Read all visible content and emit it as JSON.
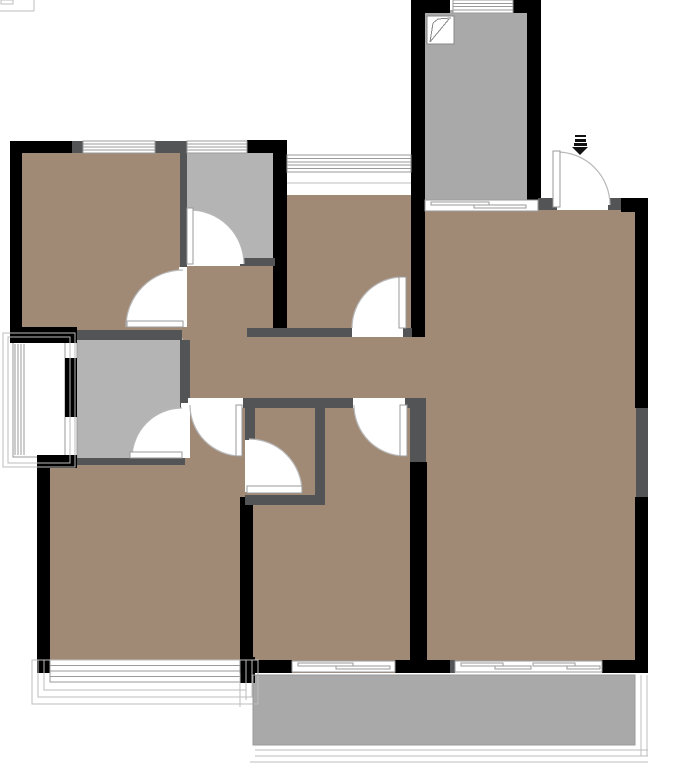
{
  "meta": {
    "width": 680,
    "height": 763,
    "kind": "apartment-floor-plan"
  },
  "plan": {
    "colors": {
      "floor": "#a08a76",
      "gray": "#b4b4b4",
      "balcony": "#a9a9a9",
      "wall_black": "#000000",
      "wall_dark": "#535456",
      "line": "#9a9a9a",
      "line_light": "#bdbdbd",
      "arc": "#b8b8b8",
      "icon": "#111111",
      "white": "#ffffff"
    },
    "fills": [
      {
        "name": "room-master-bedroom",
        "x": 22,
        "y": 152,
        "w": 165,
        "h": 185,
        "c": "floor"
      },
      {
        "name": "room-kitchen",
        "x": 285,
        "y": 172,
        "w": 128,
        "h": 165,
        "c": "floor"
      },
      {
        "name": "room-hallway",
        "x": 180,
        "y": 258,
        "w": 107,
        "h": 150,
        "c": "floor"
      },
      {
        "name": "room-corridor",
        "x": 287,
        "y": 328,
        "w": 140,
        "h": 70,
        "c": "floor"
      },
      {
        "name": "room-bedroom-left-nook",
        "x": 182,
        "y": 398,
        "w": 65,
        "h": 72,
        "c": "floor"
      },
      {
        "name": "room-bedroom-left",
        "x": 37,
        "y": 455,
        "w": 216,
        "h": 218,
        "c": "floor"
      },
      {
        "name": "room-bedroom-center",
        "x": 240,
        "y": 398,
        "w": 187,
        "h": 275,
        "c": "floor"
      },
      {
        "name": "room-living-dining",
        "x": 413,
        "y": 208,
        "w": 235,
        "h": 460,
        "c": "floor"
      },
      {
        "name": "room-walkin-gray",
        "x": 186,
        "y": 152,
        "w": 89,
        "h": 110,
        "c": "gray"
      },
      {
        "name": "room-bathroom",
        "x": 77,
        "y": 338,
        "w": 106,
        "h": 124,
        "c": "gray"
      },
      {
        "name": "room-balcony-top",
        "x": 425,
        "y": 10,
        "w": 102,
        "h": 192,
        "c": "balcony"
      },
      {
        "name": "room-balcony-bottom",
        "x": 253,
        "y": 675,
        "w": 382,
        "h": 70,
        "c": "balcony"
      }
    ],
    "walls_black": [
      [
        10,
        141,
        12,
        202
      ],
      [
        10,
        141,
        62,
        12
      ],
      [
        247,
        140,
        40,
        13
      ],
      [
        273,
        140,
        14,
        197
      ],
      [
        10,
        327,
        67,
        16
      ],
      [
        65,
        358,
        12,
        59
      ],
      [
        37,
        455,
        13,
        218
      ],
      [
        37,
        455,
        40,
        13
      ],
      [
        240,
        497,
        13,
        166
      ],
      [
        240,
        657,
        15,
        26
      ],
      [
        253,
        660,
        39,
        13
      ],
      [
        395,
        660,
        55,
        13
      ],
      [
        602,
        660,
        46,
        13
      ],
      [
        635,
        200,
        13,
        208
      ],
      [
        635,
        497,
        13,
        165
      ],
      [
        621,
        198,
        27,
        14
      ],
      [
        411,
        0,
        14,
        337
      ],
      [
        527,
        0,
        14,
        200
      ],
      [
        411,
        0,
        39,
        13
      ],
      [
        512,
        0,
        26,
        13
      ],
      [
        410,
        462,
        17,
        198
      ]
    ],
    "walls_dark": [
      [
        72,
        141,
        11,
        12
      ],
      [
        155,
        141,
        32,
        12
      ],
      [
        180,
        152,
        7,
        115
      ],
      [
        240,
        258,
        35,
        8
      ],
      [
        77,
        330,
        105,
        10
      ],
      [
        180,
        340,
        10,
        63
      ],
      [
        77,
        458,
        108,
        7
      ],
      [
        247,
        328,
        106,
        9
      ],
      [
        402,
        328,
        10,
        9
      ],
      [
        180,
        398,
        8,
        10
      ],
      [
        243,
        398,
        110,
        10
      ],
      [
        403,
        398,
        12,
        10
      ],
      [
        245,
        408,
        10,
        34
      ],
      [
        315,
        408,
        10,
        87
      ],
      [
        245,
        495,
        80,
        10
      ],
      [
        410,
        398,
        16,
        64
      ],
      [
        538,
        198,
        19,
        12
      ],
      [
        608,
        198,
        13,
        12
      ],
      [
        636,
        408,
        12,
        89
      ],
      [
        450,
        660,
        5,
        13
      ]
    ],
    "thresholds": [
      [
        179,
        267,
        8,
        60
      ],
      [
        187,
        258,
        53,
        8
      ],
      [
        181,
        403,
        9,
        55
      ],
      [
        352,
        328,
        51,
        9
      ],
      [
        188,
        398,
        55,
        10
      ],
      [
        353,
        398,
        52,
        10
      ],
      [
        245,
        440,
        10,
        52
      ],
      [
        557,
        198,
        51,
        12
      ],
      [
        287,
        172,
        124,
        23
      ]
    ],
    "windows": [
      {
        "x": 83,
        "y": 141,
        "w": 72,
        "h": 12,
        "n": 3
      },
      {
        "x": 187,
        "y": 141,
        "w": 60,
        "h": 12,
        "n": 3
      },
      {
        "x": 453,
        "y": 0,
        "w": 60,
        "h": 13,
        "n": 3
      },
      {
        "x": 287,
        "y": 155,
        "w": 124,
        "h": 17,
        "n": 4
      },
      {
        "x": 50,
        "y": 660,
        "w": 190,
        "h": 22,
        "n": 3
      }
    ],
    "sliding": [
      {
        "x": 425,
        "y": 200,
        "w": 113,
        "h": 11,
        "segs": [
          [
            431,
            202,
            58,
            3
          ],
          [
            474,
            205,
            52,
            3
          ]
        ]
      },
      {
        "x": 292,
        "y": 661,
        "w": 103,
        "h": 11,
        "segs": [
          [
            298,
            663,
            55,
            3
          ],
          [
            336,
            666,
            54,
            3
          ]
        ]
      },
      {
        "x": 455,
        "y": 661,
        "w": 147,
        "h": 11,
        "segs": [
          [
            461,
            663,
            42,
            3
          ],
          [
            495,
            666,
            36,
            3
          ],
          [
            533,
            663,
            42,
            3
          ],
          [
            567,
            666,
            33,
            3
          ]
        ]
      }
    ],
    "white_rects": [
      [
        13,
        342,
        52,
        115
      ],
      [
        65,
        342,
        12,
        17
      ],
      [
        65,
        416,
        12,
        42
      ]
    ],
    "stroke_rects": [
      {
        "r": [
          8,
          337,
          62,
          126
        ],
        "c": "line_light"
      },
      {
        "r": [
          3,
          333,
          72,
          134
        ],
        "c": "line_light"
      },
      {
        "r": [
          44,
          660,
          202,
          30
        ],
        "c": "line_light"
      },
      {
        "r": [
          38,
          660,
          214,
          37
        ],
        "c": "line_light"
      },
      {
        "r": [
          32,
          660,
          226,
          44
        ],
        "c": "line_light"
      },
      {
        "r": [
          253,
          675,
          382,
          70
        ],
        "c": "line"
      },
      {
        "r": [
          1,
          0,
          12,
          4
        ],
        "c": "line_light"
      }
    ],
    "lines": [
      {
        "p": [
          287,
          183,
          411,
          183
        ],
        "c": "line_light"
      },
      {
        "p": [
          15,
          344,
          15,
          455
        ],
        "c": "line"
      },
      {
        "p": [
          18,
          344,
          18,
          455
        ],
        "c": "line"
      },
      {
        "p": [
          21,
          344,
          21,
          455
        ],
        "c": "line"
      },
      {
        "p": [
          24,
          344,
          24,
          455
        ],
        "c": "line"
      },
      {
        "p": [
          255,
          750,
          648,
          750
        ],
        "c": "line_light"
      },
      {
        "p": [
          255,
          756,
          648,
          756
        ],
        "c": "line_light"
      },
      {
        "p": [
          250,
          762,
          648,
          762
        ],
        "c": "line_light"
      },
      {
        "p": [
          641,
          675,
          641,
          756
        ],
        "c": "line_light"
      },
      {
        "p": [
          647,
          675,
          647,
          756
        ],
        "c": "line_light"
      },
      {
        "p": [
          240,
          673,
          240,
          707
        ],
        "c": "line_light"
      },
      {
        "p": [
          246,
          673,
          246,
          700
        ],
        "c": "line_light"
      },
      {
        "p": [
          0,
          11,
          34,
          11
        ],
        "c": "line_light"
      },
      {
        "p": [
          34,
          0,
          34,
          11
        ],
        "c": "line_light"
      }
    ],
    "doors": [
      {
        "name": "door-master-bedroom",
        "cx": 183,
        "cy": 327,
        "r": 57,
        "x1": 183,
        "y1": 270,
        "x2": 126,
        "y2": 327,
        "sweep": 0,
        "leaf": [
          127,
          321,
          56,
          6
        ]
      },
      {
        "name": "door-walkin-gray",
        "cx": 190,
        "cy": 264,
        "r": 54,
        "x1": 190,
        "y1": 210,
        "x2": 244,
        "y2": 264,
        "sweep": 1,
        "leaf": [
          187,
          208,
          6,
          56
        ]
      },
      {
        "name": "door-bathroom",
        "cx": 182,
        "cy": 458,
        "r": 50,
        "x1": 182,
        "y1": 408,
        "x2": 132,
        "y2": 458,
        "sweep": 0,
        "leaf": [
          130,
          452,
          52,
          6
        ]
      },
      {
        "name": "door-kitchen",
        "cx": 403,
        "cy": 328,
        "r": 51,
        "x1": 403,
        "y1": 277,
        "x2": 352,
        "y2": 328,
        "sweep": 0,
        "leaf": [
          399,
          277,
          7,
          51
        ]
      },
      {
        "name": "door-bedroom-left",
        "cx": 241,
        "cy": 405,
        "r": 51,
        "x1": 190,
        "y1": 405,
        "x2": 241,
        "y2": 456,
        "sweep": 0,
        "leaf": [
          236,
          405,
          6,
          51
        ]
      },
      {
        "name": "door-bedroom-center",
        "cx": 405,
        "cy": 405,
        "r": 51,
        "x1": 354,
        "y1": 405,
        "x2": 405,
        "y2": 456,
        "sweep": 0,
        "leaf": [
          400,
          405,
          7,
          51
        ]
      },
      {
        "name": "door-closet",
        "cx": 249,
        "cy": 492,
        "r": 53,
        "x1": 249,
        "y1": 439,
        "x2": 302,
        "y2": 492,
        "sweep": 1,
        "leaf": [
          247,
          486,
          55,
          7
        ]
      },
      {
        "name": "door-entry",
        "cx": 557,
        "cy": 205,
        "r": 53,
        "x1": 557,
        "y1": 152,
        "x2": 610,
        "y2": 205,
        "sweep": 1,
        "leaf": [
          553,
          151,
          7,
          56
        ]
      }
    ],
    "entry_arrow": {
      "bars": [
        [
          575,
          135,
          11,
          2
        ],
        [
          575,
          139,
          11,
          3
        ],
        [
          574,
          143,
          13,
          3
        ]
      ],
      "head": "572,147 588,147 580,155"
    },
    "hatch_icon": {
      "box": [
        427,
        16,
        27,
        28
      ],
      "lines": [
        [
          430,
          42,
          433,
          23
        ],
        [
          433,
          23,
          438,
          19
        ],
        [
          438,
          19,
          451,
          18
        ],
        [
          430,
          42,
          449,
          19
        ]
      ]
    }
  }
}
